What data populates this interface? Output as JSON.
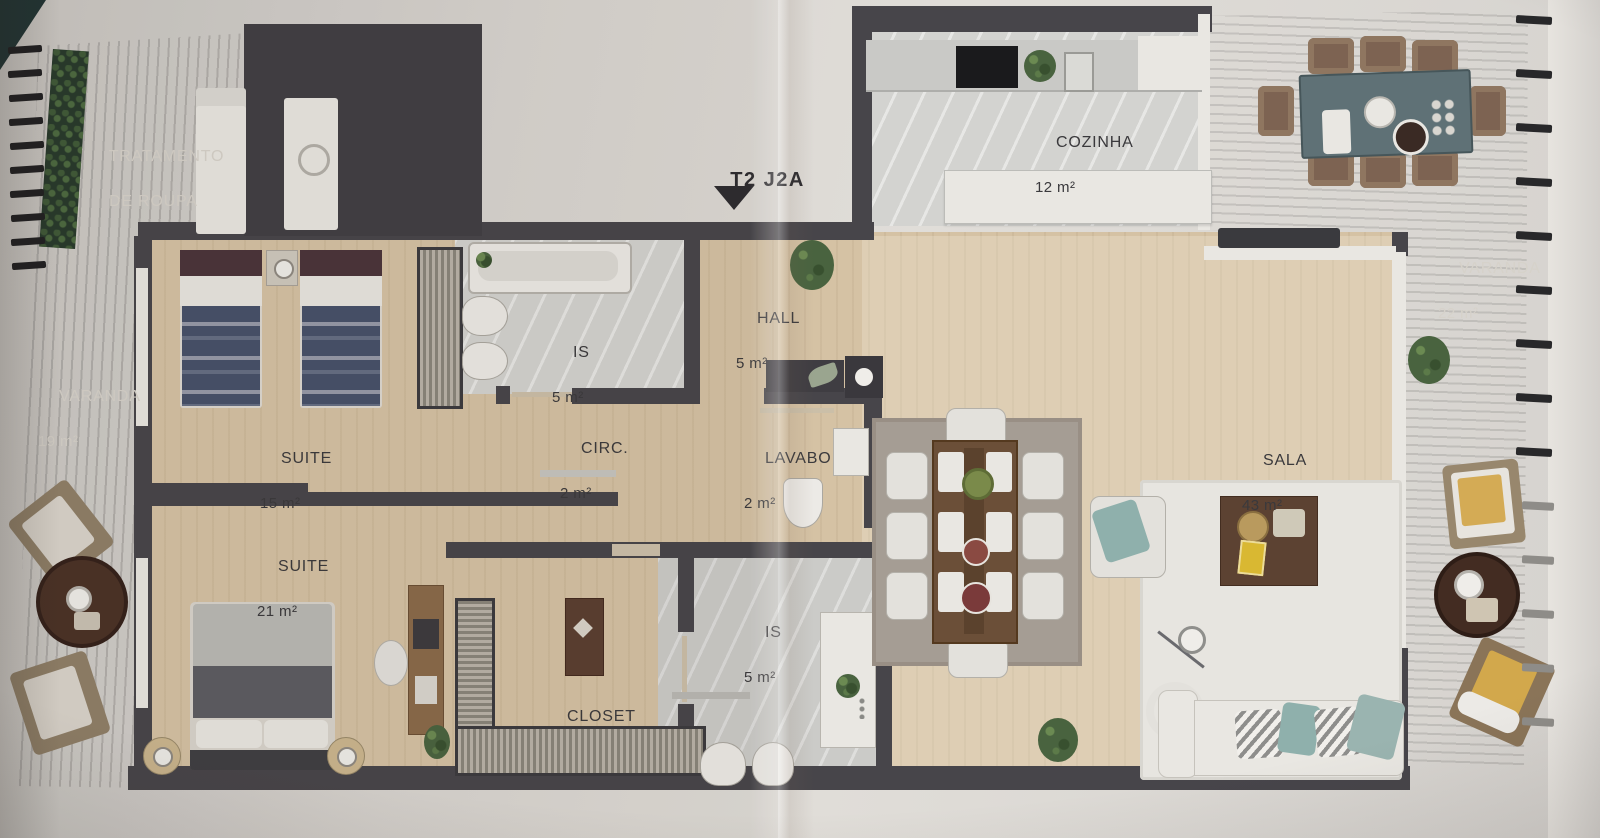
{
  "unit": {
    "label": "T2 J2A"
  },
  "rooms": [
    {
      "id": "tratamento",
      "name": "TRATAMENTO",
      "name2": "DE ROUPA",
      "area": ""
    },
    {
      "id": "cozinha",
      "name": "COZINHA",
      "area": "12 m²"
    },
    {
      "id": "varanda-right",
      "name": "VARANDA",
      "area": "22 m²"
    },
    {
      "id": "varanda-left",
      "name": "VARANDA",
      "area": "19 m²"
    },
    {
      "id": "suite-15",
      "name": "SUITE",
      "area": "15 m²"
    },
    {
      "id": "is-top",
      "name": "IS",
      "area": "5 m²"
    },
    {
      "id": "circ",
      "name": "CIRC.",
      "area": "2 m²"
    },
    {
      "id": "hall",
      "name": "HALL",
      "area": "5 m²"
    },
    {
      "id": "lavabo",
      "name": "LAVABO",
      "area": "2 m²"
    },
    {
      "id": "sala",
      "name": "SALA",
      "area": "43 m²"
    },
    {
      "id": "suite-21",
      "name": "SUITE",
      "area": "21 m²"
    },
    {
      "id": "is-bottom",
      "name": "IS",
      "area": "5 m²"
    },
    {
      "id": "closet",
      "name": "CLOSET",
      "area": ""
    }
  ],
  "colors": {
    "deck_wood": "#5c4037",
    "walls": "#47454a",
    "floor_wood": "#d5c2a4",
    "marble": "#d3d3d0",
    "paper": "#d8d5d1",
    "accent_teal": "#8fb0ac",
    "accent_yellow": "#d2a84c",
    "text_dark": "#3a393c",
    "text_light": "#d6d2ca"
  }
}
